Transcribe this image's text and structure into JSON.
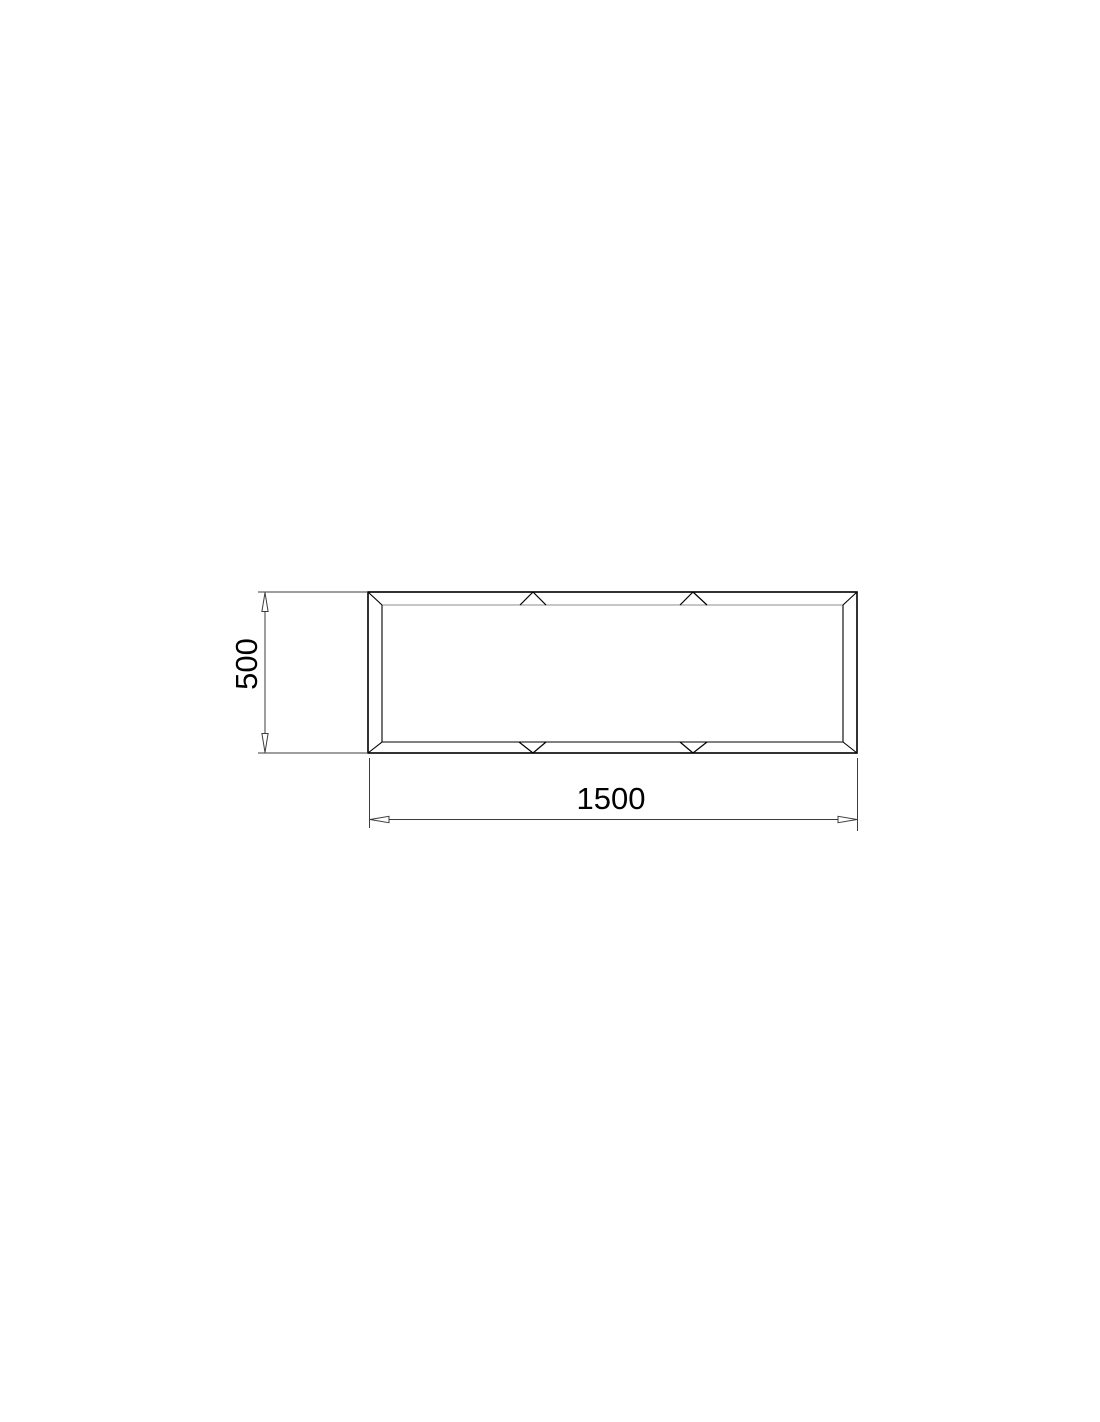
{
  "drawing": {
    "kind": "technical-drawing-orthographic-view",
    "dimensions": {
      "height": {
        "label": "500",
        "value": 500,
        "orientation": "vertical"
      },
      "width": {
        "label": "1500",
        "value": 1500,
        "orientation": "horizontal"
      }
    },
    "frame": {
      "joint_marks_top": 2,
      "joint_marks_bottom": 2,
      "mitered_corners": 4
    },
    "colors": {
      "background": "#ffffff",
      "edge": "#000000",
      "inner_top_edge": "#8c8c8c",
      "dimension_line": "#3c3c3c",
      "text": "#000000"
    }
  }
}
